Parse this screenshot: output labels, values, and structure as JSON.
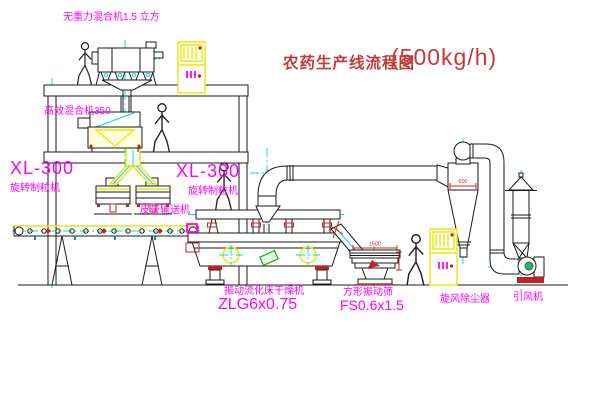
{
  "title": {
    "text": "农药生产线流程图",
    "capacity": "(500kg/h)"
  },
  "equipment": {
    "gravity_mixer": {
      "label": "无重力混合机1.5 立方"
    },
    "high_eff_mixer": {
      "label": "高效混合机350"
    },
    "granulator_left": {
      "model": "XL-300",
      "name": "旋转制粒机"
    },
    "granulator_right": {
      "model": "XL-300",
      "name": "旋转制粒机"
    },
    "belt_conveyor": {
      "name": "皮带输送机"
    },
    "dryer": {
      "name": "振动流化床干燥机",
      "model": "ZLG6x0.75"
    },
    "screen": {
      "name": "方形振动筛",
      "model": "FS0.6x1.5",
      "dim_width": "1500"
    },
    "cyclone": {
      "name": "旋风除尘器",
      "dim_width": "600"
    },
    "fan": {
      "name": "引风机"
    }
  },
  "colors": {
    "label_magenta": "#ff00ff",
    "title_red": "#c23b3b",
    "centerline_cyan": "#00dcdc",
    "equipment_yellow": "#e8e800",
    "dimension_red": "#d22222",
    "background": "#ffffff"
  }
}
